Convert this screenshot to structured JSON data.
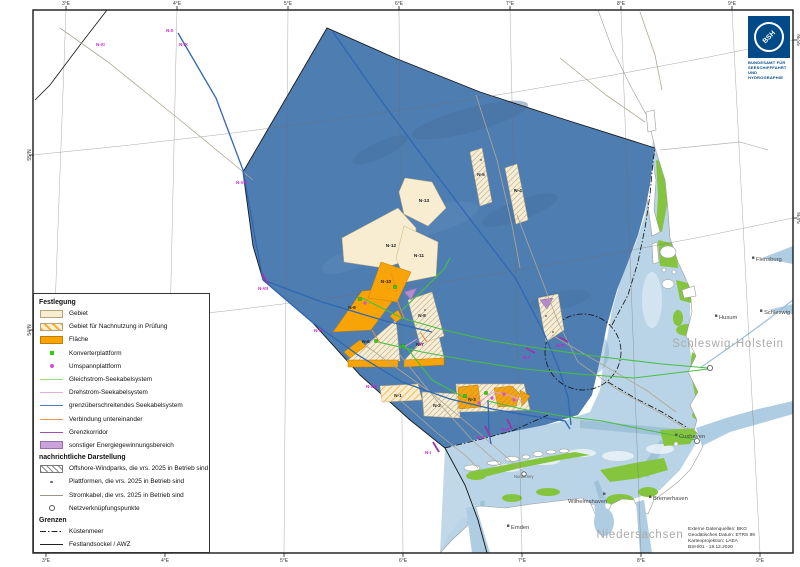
{
  "frame": {
    "ticks_top": [
      {
        "label": "3°E"
      },
      {
        "label": "4°E"
      },
      {
        "label": "5°E"
      },
      {
        "label": "6°E"
      },
      {
        "label": "7°E"
      },
      {
        "label": "8°E"
      },
      {
        "label": "9°E"
      }
    ],
    "ticks_bottom": [
      {
        "label": "3°E"
      },
      {
        "label": "4°E"
      },
      {
        "label": "5°E"
      },
      {
        "label": "6°E"
      },
      {
        "label": "7°E"
      },
      {
        "label": "8°E"
      },
      {
        "label": "9°E"
      }
    ],
    "ticks_left": [
      {
        "label": "55°N"
      },
      {
        "label": "54°N"
      }
    ],
    "ticks_right": [
      {
        "label": "55°N"
      },
      {
        "label": "54°N"
      }
    ]
  },
  "legend": {
    "sections": [
      {
        "title": "Festlegung",
        "items": [
          {
            "label": "Gebiet"
          },
          {
            "label": "Gebiet für Nachnutzung in Prüfung"
          },
          {
            "label": "Fläche"
          },
          {
            "label": "Konverterplattform"
          },
          {
            "label": "Umspannplattform"
          },
          {
            "label": "Gleichstrom-Seekabelsystem"
          },
          {
            "label": "Drehstrom-Seekabelsystem"
          },
          {
            "label": "grenzüberschreitendes Seekabelsystem"
          },
          {
            "label": "Verbindung untereinander"
          },
          {
            "label": "Grenzkorridor"
          },
          {
            "label": "sonstiger Energiegewinnungsbereich"
          }
        ]
      },
      {
        "title": "nachrichtliche Darstellung",
        "items": [
          {
            "label": "Offshore-Windparks, die vrs. 2025 in Betrieb sind"
          },
          {
            "label": "Plattformen, die vrs. 2025 in Betrieb sind"
          },
          {
            "label": "Stromkabel, die vrs. 2025 in Betrieb sind"
          },
          {
            "label": "Netzverknüpfungspunkte"
          }
        ]
      },
      {
        "title": "Grenzen",
        "items": [
          {
            "label": "Küstenmeer"
          },
          {
            "label": "Festlandsockel / AWZ"
          }
        ]
      }
    ]
  },
  "map": {
    "area_labels": [
      {
        "text": "N-13"
      },
      {
        "text": "N-12"
      },
      {
        "text": "N-11"
      },
      {
        "text": "N-10"
      },
      {
        "text": "N-9"
      },
      {
        "text": "N-8"
      },
      {
        "text": "N-7"
      },
      {
        "text": "N-6"
      },
      {
        "text": "N-5"
      },
      {
        "text": "N-4"
      },
      {
        "text": "N-3"
      },
      {
        "text": "N-2"
      },
      {
        "text": "N-1"
      }
    ],
    "corridor_labels": [
      {
        "text": "N-XI"
      },
      {
        "text": "N-X"
      },
      {
        "text": "N-IX"
      },
      {
        "text": "N-VIII"
      },
      {
        "text": "N-VII"
      },
      {
        "text": "N-VI"
      },
      {
        "text": "N-XIII"
      },
      {
        "text": "N-V"
      },
      {
        "text": "N-IV"
      },
      {
        "text": "N-III"
      },
      {
        "text": "N-II"
      },
      {
        "text": "N-I"
      }
    ],
    "cities": [
      {
        "name": "Flensburg"
      },
      {
        "name": "Schleswig"
      },
      {
        "name": "Husum"
      },
      {
        "name": "Cuxhaven"
      },
      {
        "name": "Bremerhaven"
      },
      {
        "name": "Wilhelmshaven"
      },
      {
        "name": "Emden"
      },
      {
        "name": "Norderney"
      }
    ],
    "regions": [
      {
        "label": "Schleswig-Holstein"
      },
      {
        "label": "Niedersachsen"
      }
    ]
  },
  "logo": {
    "abbr": "BSH",
    "org_lines": [
      "BUNDESAMT FÜR",
      "SEESCHIFFFAHRT",
      "UND",
      "HYDROGRAPHIE"
    ]
  },
  "source_box": {
    "lines": [
      "Externe Datenquellen: BKG",
      "Geodätisches Datum: ETRS 89",
      "Kartenprojektion: LAEA",
      "BSH/01 - 18.12.2020"
    ]
  },
  "colors": {
    "awz_sea": "#4e7db1",
    "coastal_sea": "#b9d4e6",
    "tidal_flats": "#85c43d",
    "gebiet": "#f8edd0",
    "flaeche": "#f8a406",
    "sonstiger_bereich": "#c9a3d9",
    "konverterplattform": "#2ed00a",
    "umspannplattform": "#d24fd2",
    "gleichstrom_kabel": "#46bf43",
    "drehstrom_kabel": "#dd9fdd",
    "grenzueberschreitendes_kabel": "#2f67b2",
    "verbindung": "#ef8a3c",
    "grenzkorridor": "#9a35a8",
    "logo_blue": "#004a87"
  }
}
